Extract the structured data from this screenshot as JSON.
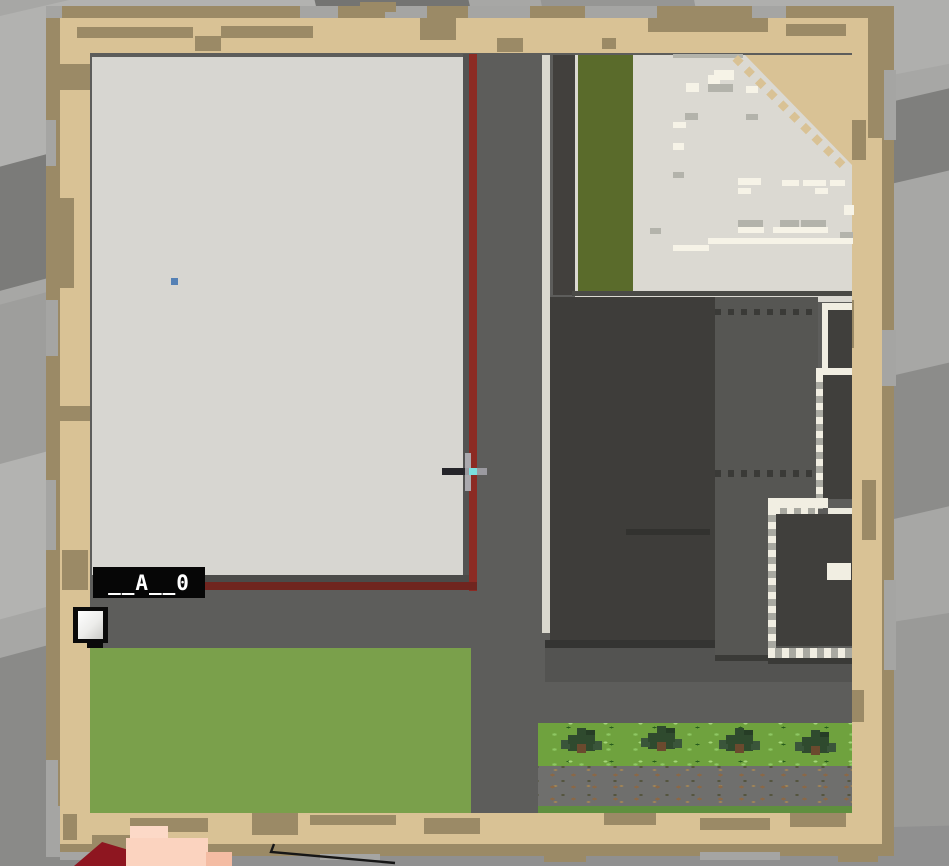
{
  "map": {
    "label": "__A__0",
    "markers": {
      "player_marker_icon": "white-map-marker-icon",
      "position_dot_icon": "blue-dot-marker-icon",
      "tree_icon": "tree-icon"
    },
    "colors": {
      "parchment": "#d9c295",
      "parchment_dark": "#9b8a66",
      "roof_light": "#d7d6d1",
      "road_gray": "#5d5d5b",
      "outline_red": "#8c2b24",
      "grass_bright": "#7aa04b",
      "field_olive": "#5a6b2b",
      "building_dark": "#3e3d3a",
      "building_mid": "#565653",
      "trail_white": "#f1eee2",
      "marker_blue": "#5581b5",
      "label_bg": "#000000",
      "label_text": "#ffffff"
    }
  },
  "hud": {
    "crosshair_icon": "crosshair-icon"
  }
}
